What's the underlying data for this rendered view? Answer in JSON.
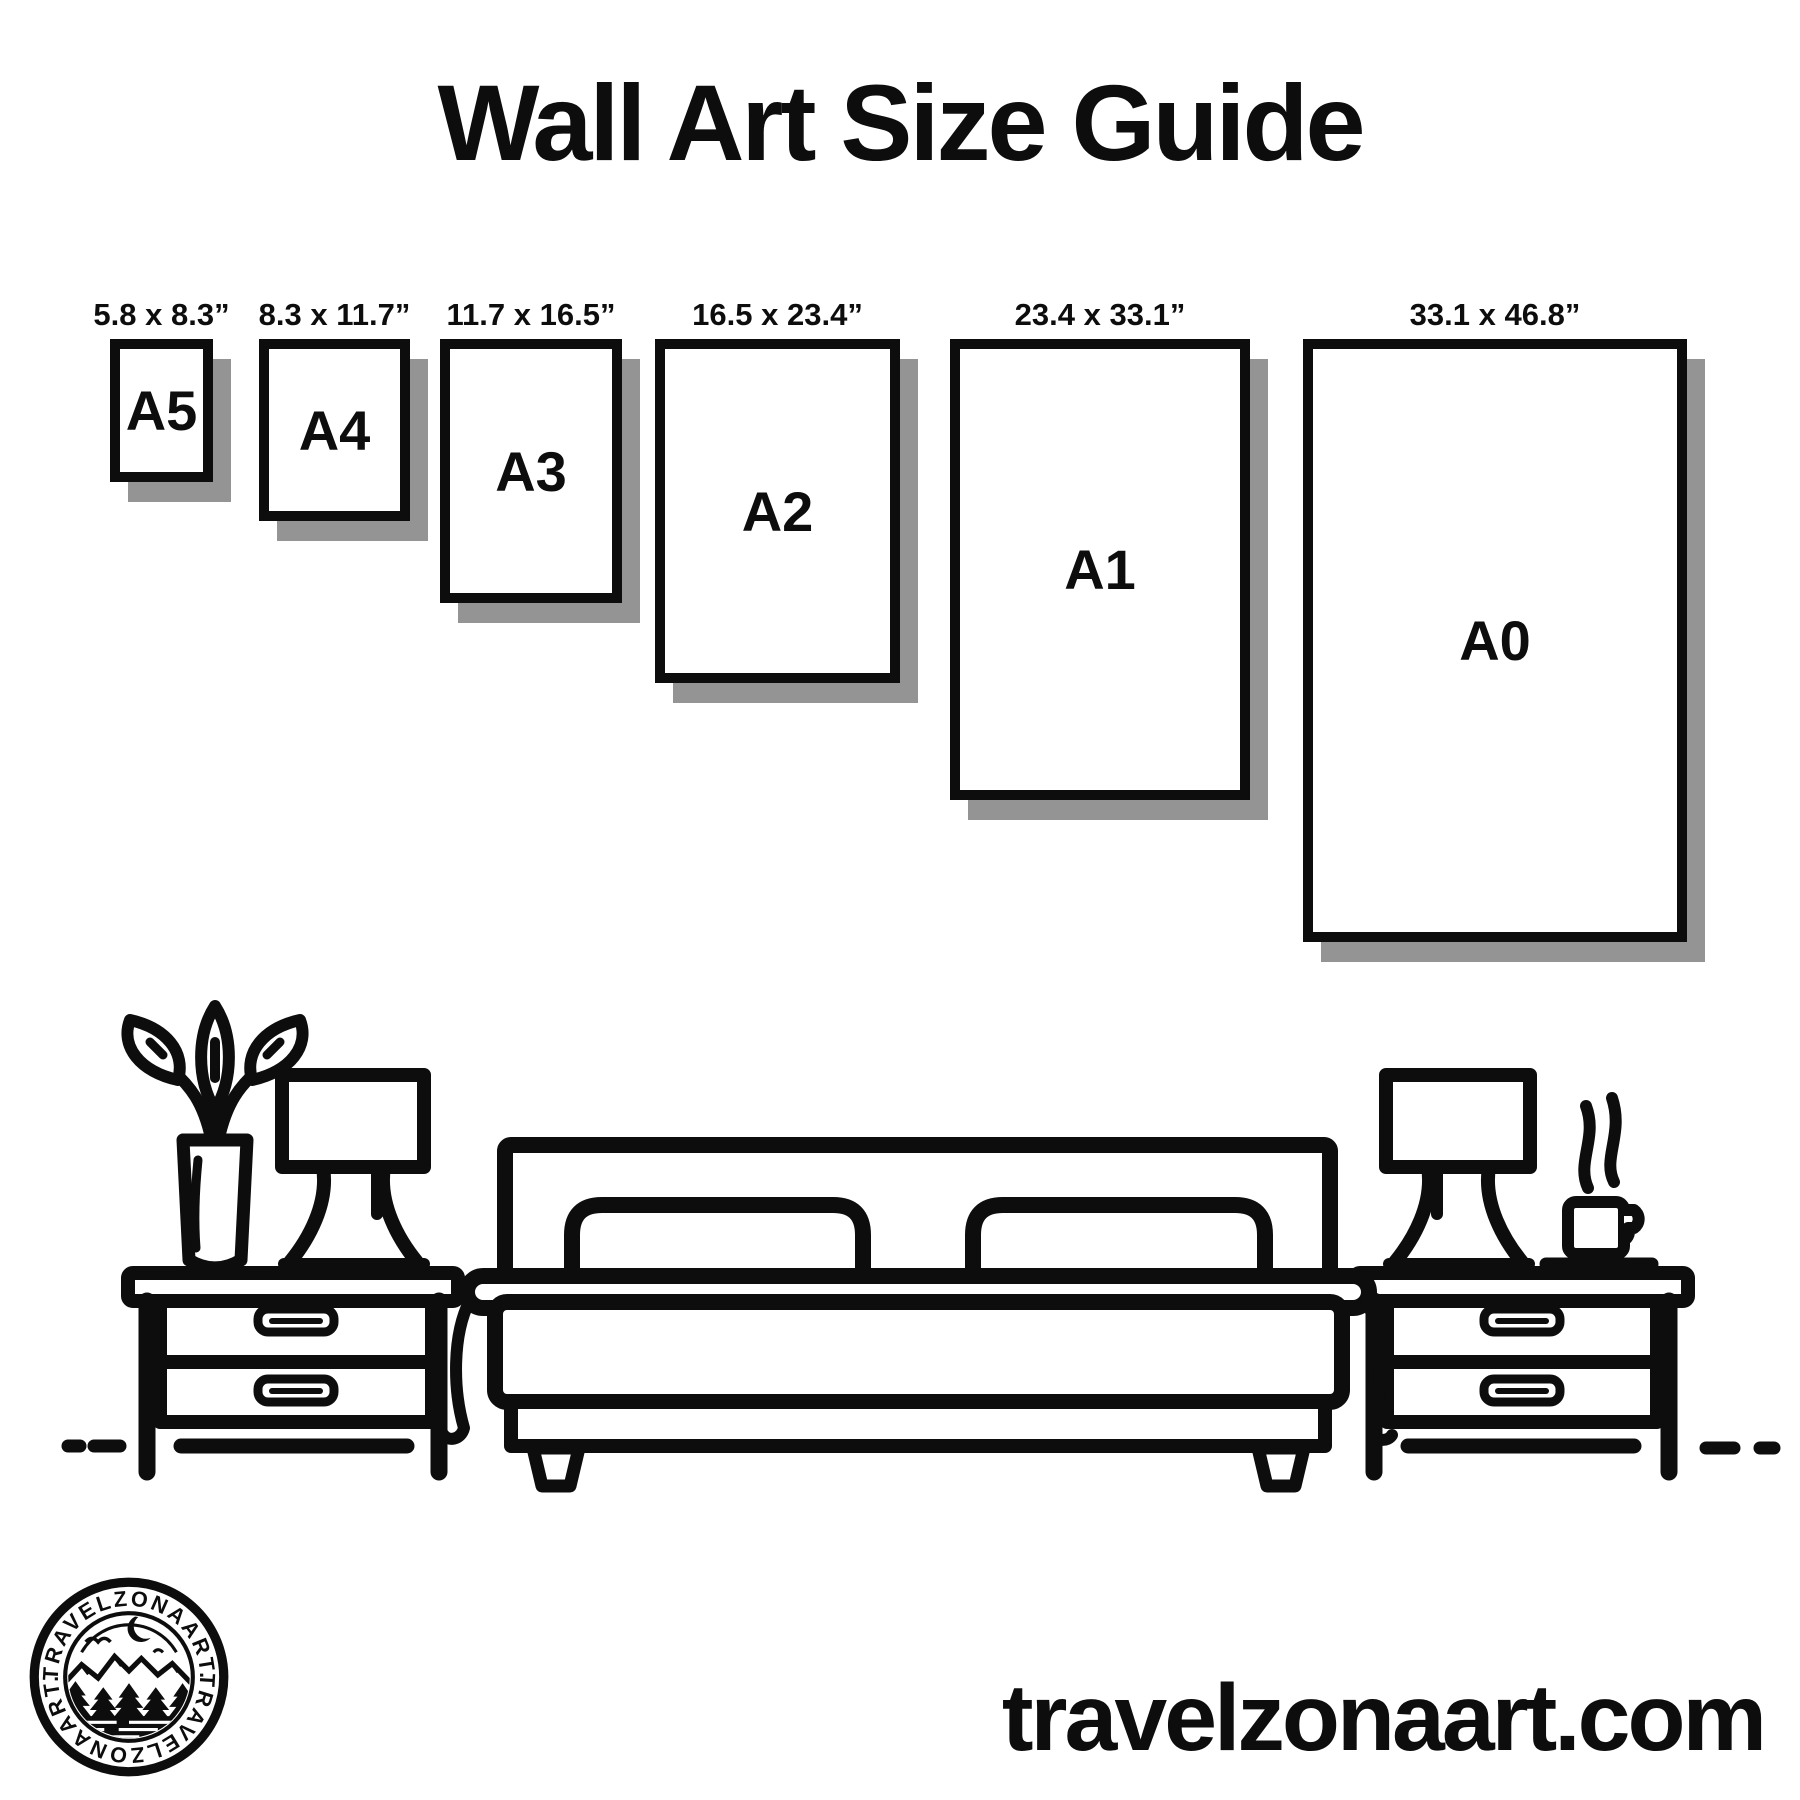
{
  "title": "Wall Art Size Guide",
  "papers": [
    {
      "name": "A5",
      "dimensions": "5.8 x 8.3”"
    },
    {
      "name": "A4",
      "dimensions": "8.3 x 11.7”"
    },
    {
      "name": "A3",
      "dimensions": "11.7 x 16.5”"
    },
    {
      "name": "A2",
      "dimensions": "16.5 x 23.4”"
    },
    {
      "name": "A1",
      "dimensions": "23.4 x 33.1”"
    },
    {
      "name": "A0",
      "dimensions": "33.1 x 46.8”"
    }
  ],
  "logo": {
    "brand_top": "TRAVELZONAART.",
    "brand_bottom": "TRAVELZONAART."
  },
  "footer": {
    "website": "travelzonaart.com"
  },
  "colors": {
    "ink": "#0d0d0d",
    "shadow": "#949494",
    "background": "#ffffff"
  }
}
